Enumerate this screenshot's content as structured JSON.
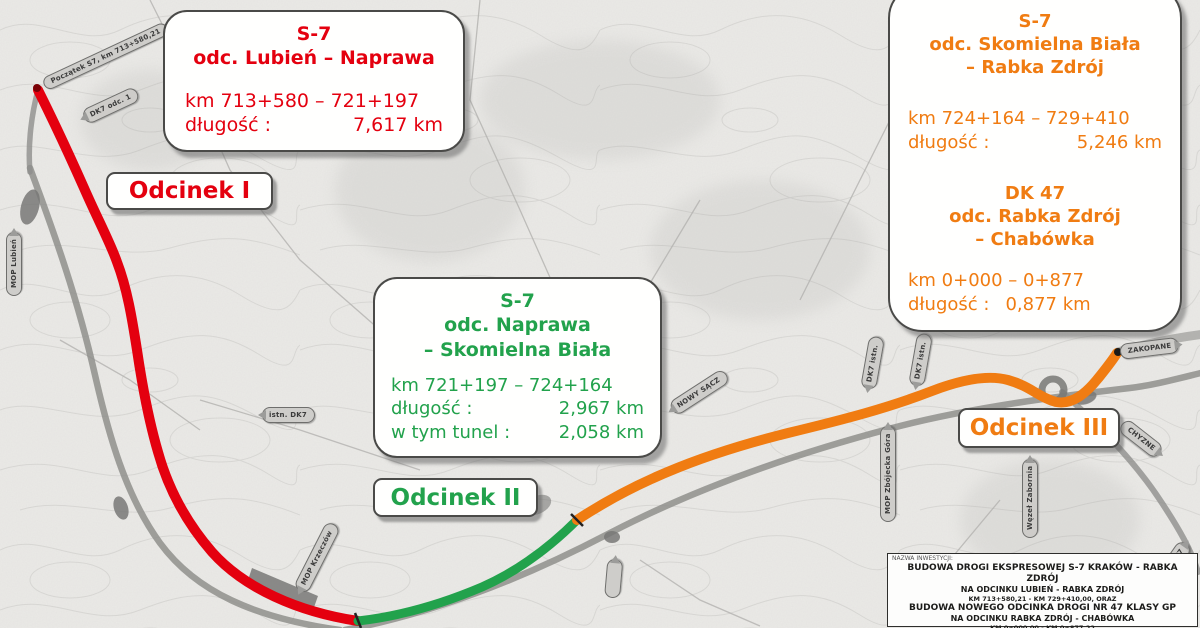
{
  "colors": {
    "s1": "#e4000f",
    "s2": "#22a24c",
    "s3": "#f07c12",
    "existing_road": "#8f8f8c"
  },
  "callouts": {
    "s1": {
      "road": "S-7",
      "segment": "odc. Lubień – Naprawa",
      "km": "km 713+580 – 721+197",
      "length_label": "długość :",
      "length_value": "7,617 km"
    },
    "s2": {
      "road": "S-7",
      "segment_line1": "odc. Naprawa",
      "segment_line2": "– Skomielna Biała",
      "km": "km 721+197 – 724+164",
      "length_label": "długość :",
      "length_value": "2,967 km",
      "tunnel_label": "w tym tunel :",
      "tunnel_value": "2,058 km"
    },
    "s3a": {
      "road": "S-7",
      "segment_line1": "odc.  Skomielna Biała",
      "segment_line2": "– Rabka Zdrój",
      "km": "km 724+164 – 729+410",
      "length_label": "długość :",
      "length_value": "5,246 km"
    },
    "s3b": {
      "road": "DK 47",
      "segment_line1": "odc. Rabka Zdrój",
      "segment_line2": "– Chabówka",
      "km": "km 0+000 – 0+877",
      "length_label": "długość :",
      "length_value": "0,877 km"
    }
  },
  "section_labels": {
    "s1": "Odcinek I",
    "s2": "Odcinek II",
    "s3": "Odcinek III"
  },
  "info_box": {
    "caption": "NAZWA INWESTYCJI:",
    "line1": "BUDOWA DROGI EKSPRESOWEJ S-7 KRAKÓW - RABKA ZDRÓJ",
    "line2": "NA ODCINKU LUBIEŃ - RABKA ZDRÓJ",
    "line3": "KM 713+580,21 - KM 729+410,00, ORAZ",
    "line4": "BUDOWA NOWEGO ODCINKA DROGI NR 47 KLASY GP",
    "line5": "NA ODCINKU RABKA ZDRÓJ - CHABÓWKA",
    "line6": "KM 0+000,00 - KM 0+877,22"
  },
  "map_labels": {
    "start": "Początek S7, km 713+580,21",
    "dk7_odc": "DK7 odc. 1",
    "mop_lubien": "MOP Lubień",
    "istn_dk7": "istn. DK7",
    "mop_krzeczow": "MOP Krzeczów",
    "nowy_sacz": "NOWY SĄCZ",
    "dk7_istn_a": "DK7 istn.",
    "dk7_istn_b": "DK7 istn.",
    "mop_zbojecka": "MOP Zbójecka Góra",
    "wezel_zabornia": "Węzeł Zabornia",
    "zakopane": "ZAKOPANE",
    "chyzne": "CHYZNE",
    "dk7_se": "DK7"
  }
}
